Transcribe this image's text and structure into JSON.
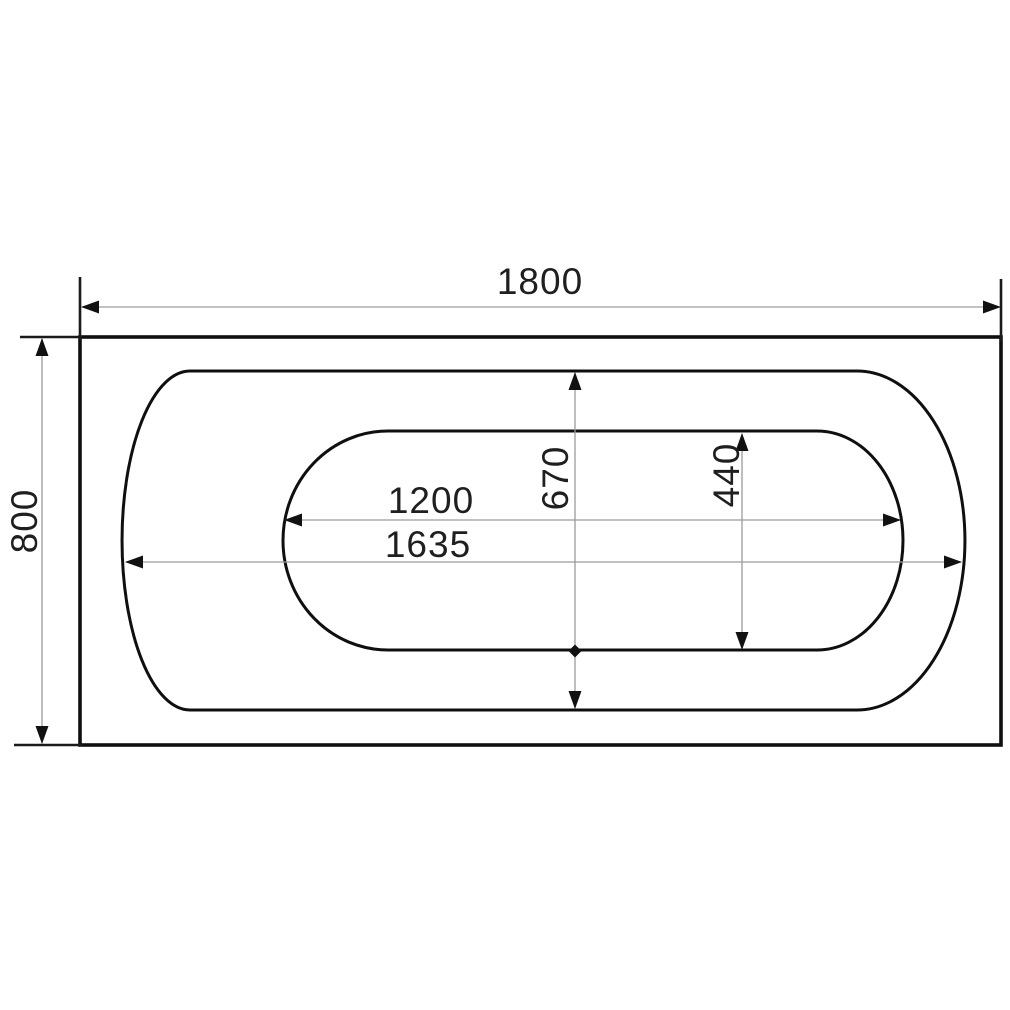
{
  "drawing": {
    "type": "technical-drawing",
    "subject": "bathtub-top-view",
    "units_shown": false,
    "dimensions": {
      "overall_length": "1800",
      "overall_width": "800",
      "basin_length": "1200",
      "rim_opening_length": "1635",
      "rim_opening_width": "670",
      "basin_width": "440"
    },
    "colors": {
      "outline": "#0f0f0f",
      "dimension_line": "#9c9c9c",
      "text": "#1f1f1f",
      "background": "#ffffff"
    }
  }
}
